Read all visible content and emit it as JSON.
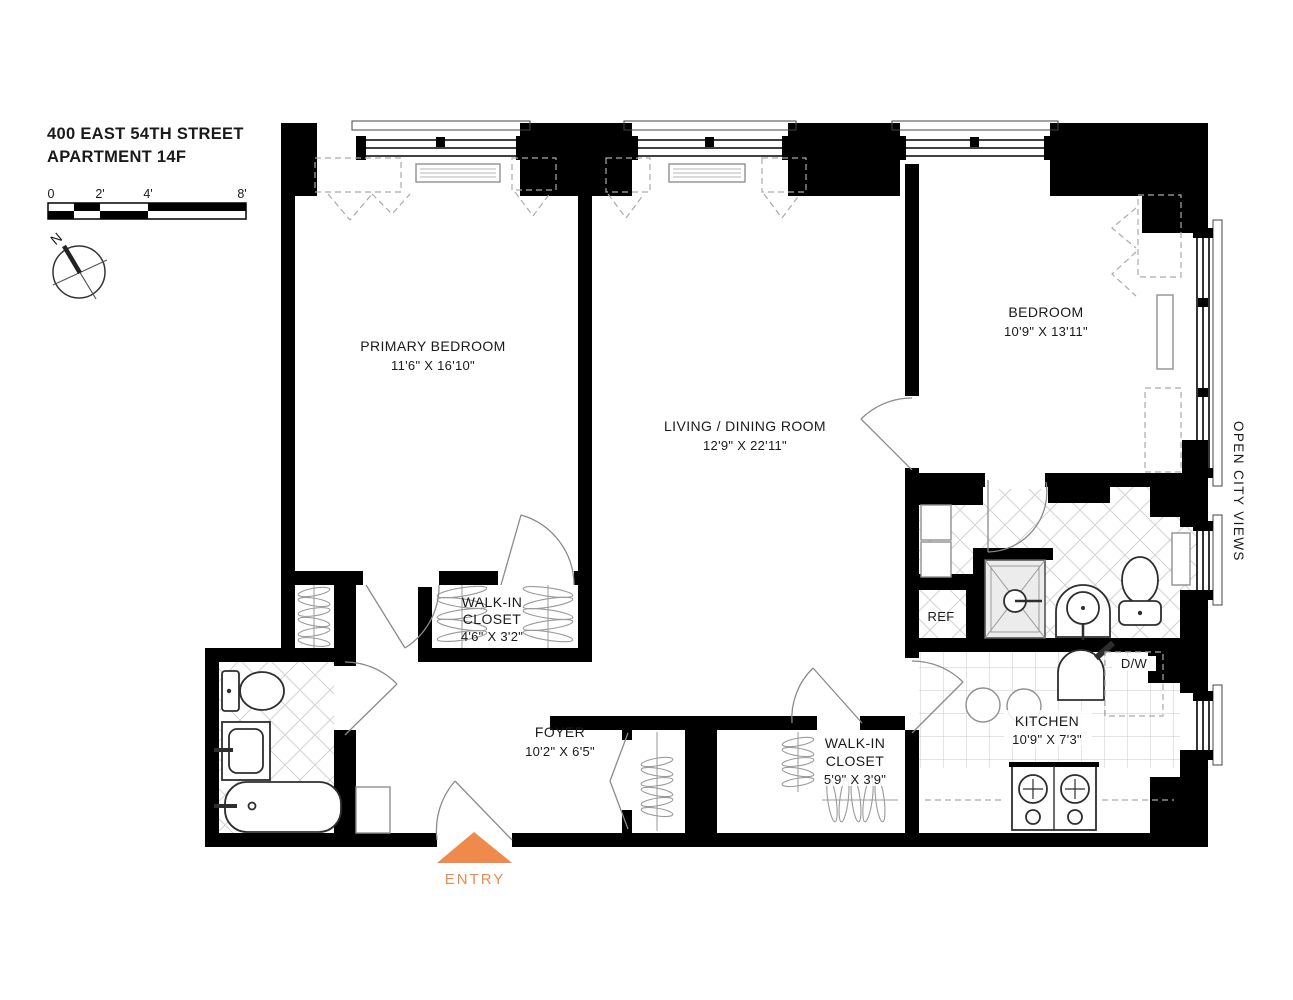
{
  "title": {
    "line1": "400 EAST 54TH STREET",
    "line2": "APARTMENT 14F"
  },
  "scale_bar": {
    "tick_labels": [
      "0",
      "2'",
      "4'",
      "8'"
    ]
  },
  "compass": {
    "north_label": "N"
  },
  "rooms": {
    "primary_bedroom": {
      "name": "PRIMARY BEDROOM",
      "dimensions": "11'6\" X 16'10\""
    },
    "living_dining": {
      "name": "LIVING / DINING ROOM",
      "dimensions": "12'9\" X 22'11\""
    },
    "bedroom": {
      "name": "BEDROOM",
      "dimensions": "10'9\" X 13'11\""
    },
    "walk_in_closet_primary": {
      "name_lines": [
        "WALK-IN",
        "CLOSET"
      ],
      "dimensions": "4'6\" X 3'2\""
    },
    "foyer": {
      "name": "FOYER",
      "dimensions": "10'2\" X 6'5\""
    },
    "walk_in_closet_foyer": {
      "name_lines": [
        "WALK-IN",
        "CLOSET"
      ],
      "dimensions": "5'9\" X 3'9\""
    },
    "kitchen": {
      "name": "KITCHEN",
      "dimensions": "10'9\" X 7'3\""
    }
  },
  "appliances": {
    "refrigerator": "REF",
    "dishwasher": "D/W"
  },
  "annotations": {
    "view": "OPEN CITY VIEWS",
    "entry": "ENTRY"
  },
  "colors": {
    "entry_accent": "#EF8A4C",
    "walls": "#000000",
    "paper": "#FFFFFF"
  }
}
